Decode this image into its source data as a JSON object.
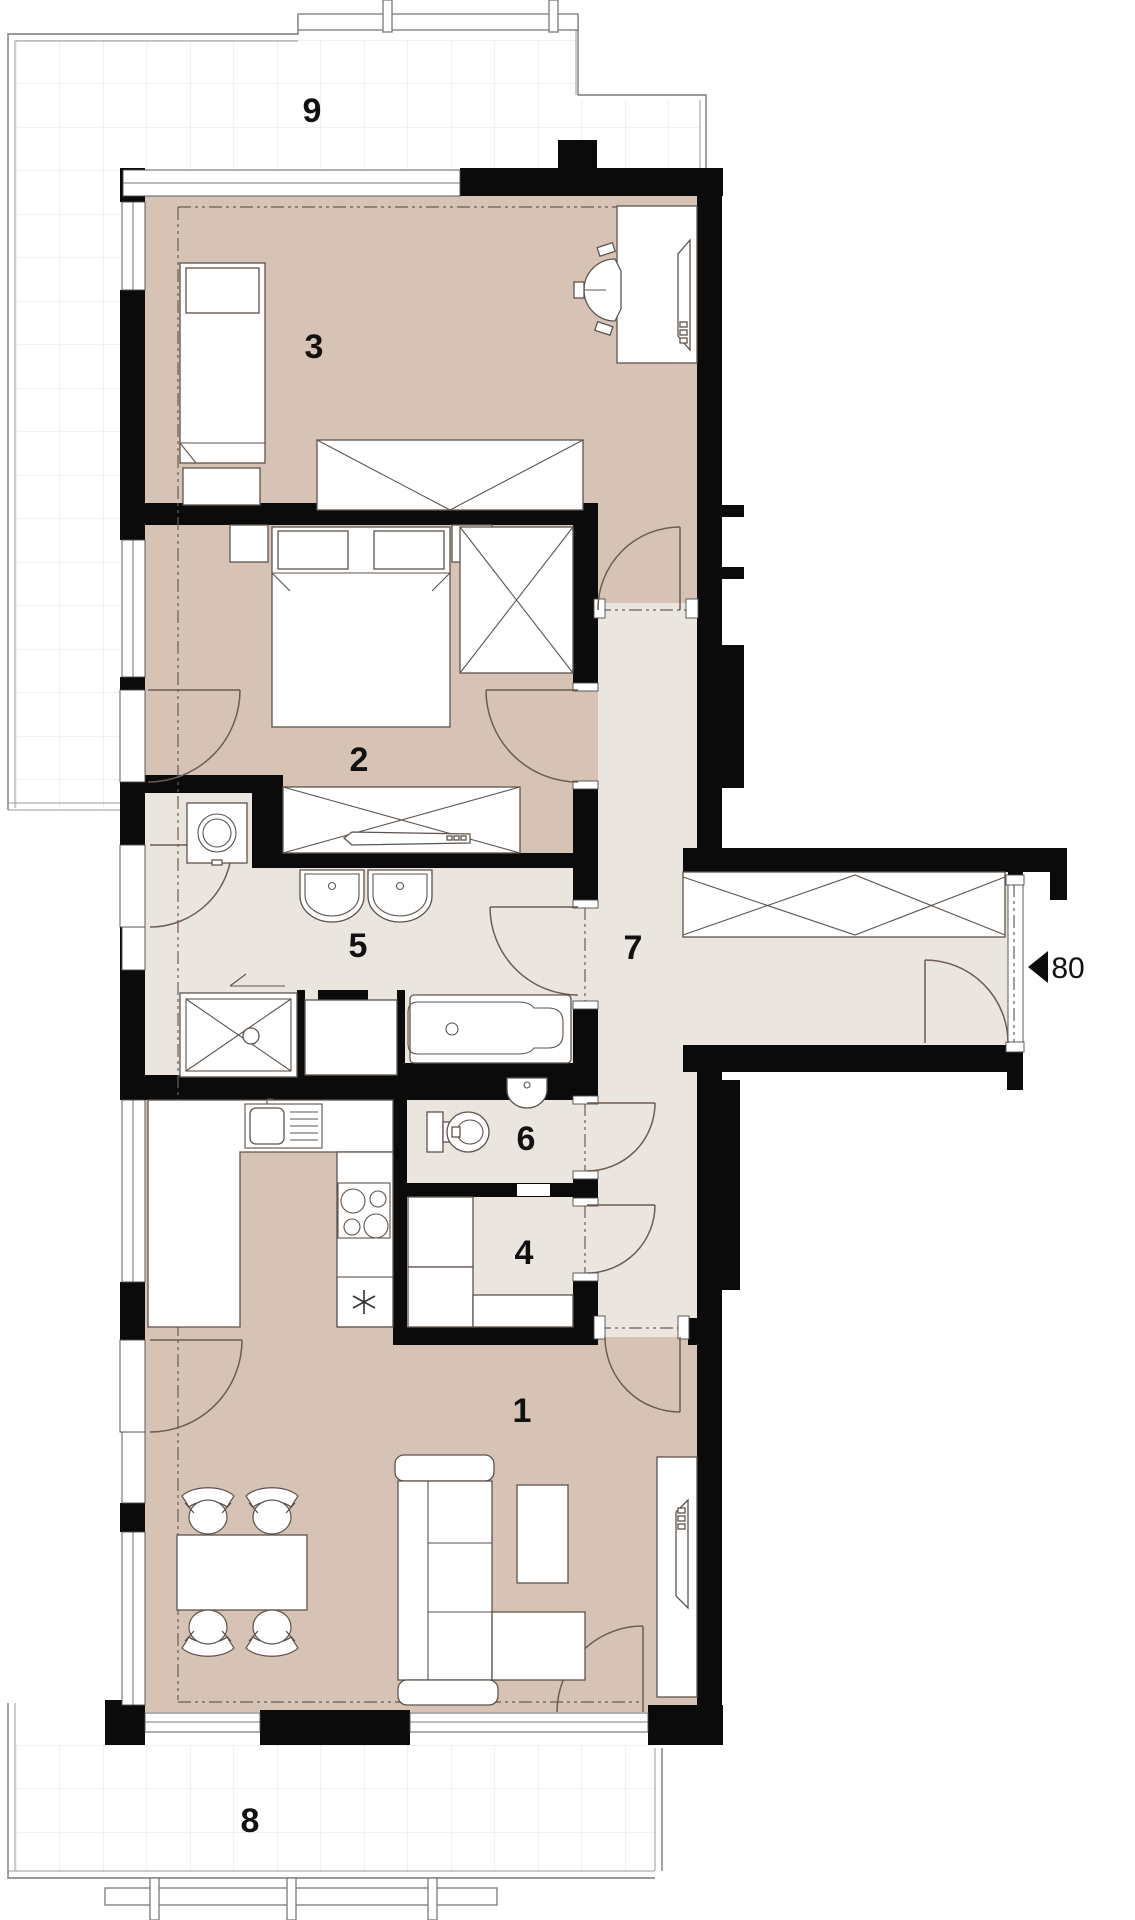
{
  "labels": {
    "living_room": "1",
    "bedroom_main": "2",
    "bedroom_second": "3",
    "storage": "4",
    "bathroom": "5",
    "wc": "6",
    "hall": "7",
    "terrace_bottom": "8",
    "terrace_top": "9",
    "entry_door_width": "80"
  },
  "colors": {
    "floor_warm": "#d7c3b5",
    "floor_light": "#eae5de",
    "wall": "#0b0b0b",
    "outline": "#5d534c",
    "grid_line": "#e3e3e3",
    "terrace_border": "#7a7a7a"
  }
}
